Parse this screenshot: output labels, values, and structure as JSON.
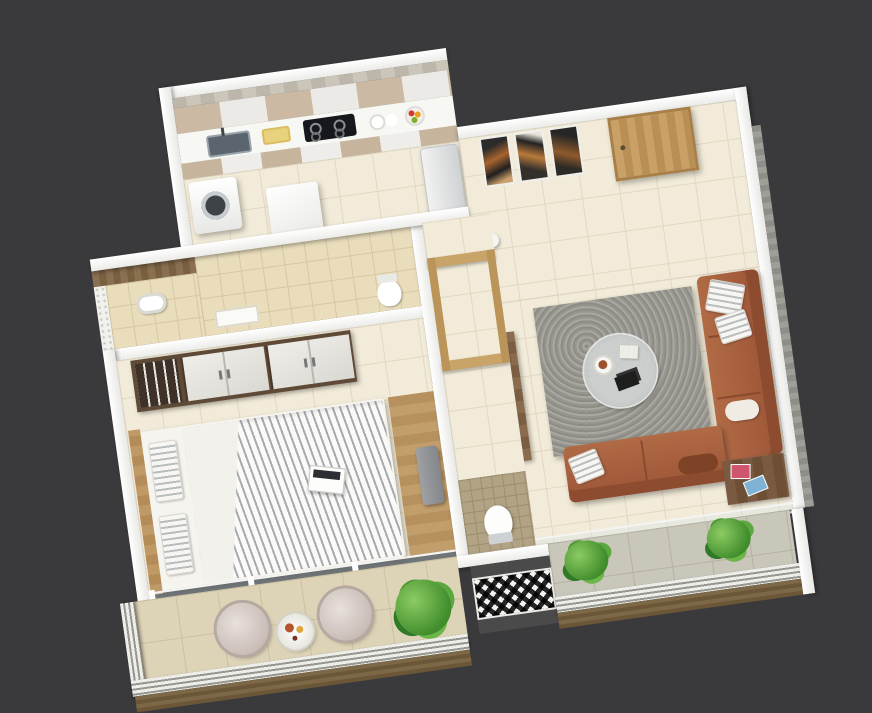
{
  "scene": {
    "title": "3D isometric floor plan render of a one-bedroom apartment",
    "view": "top-down isometric, rotated about -8 degrees",
    "background_color": "#3a3a3c",
    "wall_color": "#ffffff",
    "visible_text": "none (image contains no rendered text)"
  },
  "palette": {
    "floor_cream": "#f2ebd9",
    "floor_bath_beige": "#e9ddbc",
    "floor_balcony_beige": "#ddd3b7",
    "floor_balcony_gray": "#c9c6ba",
    "floor_wc_mosaic": "#b2a384",
    "wood_accent": "#b98f5c",
    "sofa_leather": "#a9613f",
    "rug_gray": "#9b9a93",
    "plant_green": "#4f9b3a",
    "duct_pattern": "black & white trellis tile"
  },
  "rooms": {
    "kitchen": {
      "name": "Kitchen",
      "items": [
        "upper-cabinets",
        "concrete-backsplash",
        "counter",
        "sink",
        "gas-hob-4-burner",
        "cutting-board",
        "plates",
        "fruit-bowl",
        "washing-machine",
        "base-cabinets",
        "refrigerator",
        "white-stool"
      ]
    },
    "foyer": {
      "name": "Entrance Foyer",
      "items": [
        "entry-door-wood",
        "wall-art-triptych",
        "decor-vase"
      ]
    },
    "living_room": {
      "name": "Living Room",
      "items": [
        "gray-shag-rug",
        "round-coffee-table",
        "books",
        "snack-plate",
        "l-shaped-brown-sofa",
        "white-throw-pillows",
        "corner-side-table",
        "magazines",
        "tv-unit",
        "television"
      ]
    },
    "bedroom": {
      "name": "Bedroom",
      "items": [
        "wardrobe-white-doors",
        "open-hanger-section",
        "double-bed",
        "striped-duvet",
        "striped-pillows",
        "wood-headboard",
        "laptop",
        "wood-floor-runner",
        "gray-chair"
      ]
    },
    "ensuite_bath": {
      "name": "Ensuite Bath",
      "items": [
        "wood-accent-wall",
        "washbasin",
        "white-jali-screen"
      ]
    },
    "bathroom": {
      "name": "Bathroom",
      "items": [
        "beige-wall-tiles",
        "washbasin-counter",
        "toilet"
      ]
    },
    "passage": {
      "name": "Passage",
      "items": [
        "wood-portal-frames"
      ]
    },
    "wc": {
      "name": "WC",
      "items": [
        "toilet",
        "mosaic-floor"
      ]
    },
    "bedroom_balcony": {
      "name": "Bedroom Balcony",
      "items": [
        "egg-chair",
        "egg-chair",
        "bistro-table",
        "breakfast-tray",
        "large-planter",
        "metal-railing"
      ]
    },
    "living_balcony": {
      "name": "Living Balcony",
      "items": [
        "potted-plant",
        "potted-plant",
        "metal-railing",
        "sliding-door-track"
      ]
    },
    "duct": {
      "name": "Service Duct",
      "items": [
        "patterned-cement-tile"
      ]
    }
  },
  "counts": {
    "egg_chairs": 2,
    "balcony_plants_right": 2,
    "art_frames": 3,
    "hob_burners": 4,
    "wardrobe_door_units": 2
  }
}
